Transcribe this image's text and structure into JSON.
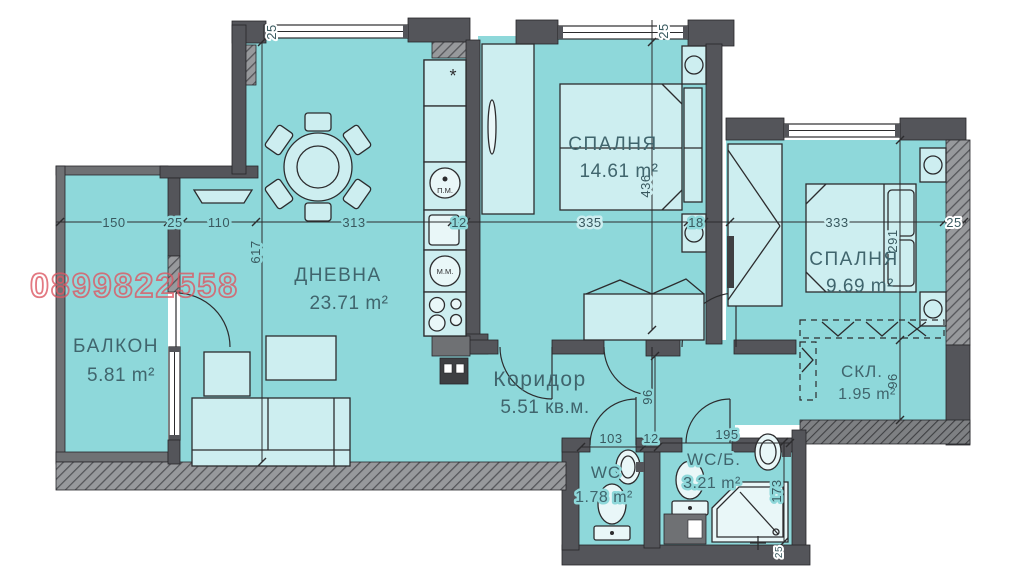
{
  "watermark": {
    "text": "0899822558"
  },
  "rooms": {
    "balcony": {
      "name": "БАЛКОН",
      "area": "5.81 m²"
    },
    "living": {
      "name": "ДНЕВНА",
      "area": "23.71 m²"
    },
    "bedroom1": {
      "name": "СПАЛНЯ",
      "area": "14.61 m²"
    },
    "bedroom2": {
      "name": "СПАЛНЯ",
      "area": "9.69 m²"
    },
    "storage": {
      "name": "СКЛ.",
      "area": "1.95 m²"
    },
    "corridor": {
      "name": "Коридор",
      "area": "5.51 кв.м."
    },
    "wc": {
      "name": "WC",
      "area": "1.78 m²"
    },
    "bathroom": {
      "name": "WC/Б.",
      "area": "3.21 m²"
    }
  },
  "appliances": {
    "washing_machine": "П.М.",
    "dishwasher": "М.М.",
    "freezer_symbol": "*"
  },
  "dims": {
    "h_main": [
      "150",
      "25",
      "110",
      "313",
      "12",
      "335",
      "18",
      "333",
      "25"
    ],
    "v_living": "617",
    "wall_top_left": "25",
    "v_bedroom1": "436",
    "wall_bedroom1_top": "25",
    "v_bedroom2": "291",
    "v_corridor": "96",
    "v_storage": "96",
    "v_bathroom": "173",
    "wall_bathroom_bottom": "25",
    "wc_width": "103",
    "wc_wall": "12",
    "bathroom_width": "195"
  },
  "colors": {
    "room_fill": "#8ed8da",
    "furniture_fill": "#cdeef0",
    "wall_dark": "#54555a",
    "wall_medium": "#6f7174",
    "watermark_red": "#dd5863",
    "label_text": "#40656d"
  }
}
